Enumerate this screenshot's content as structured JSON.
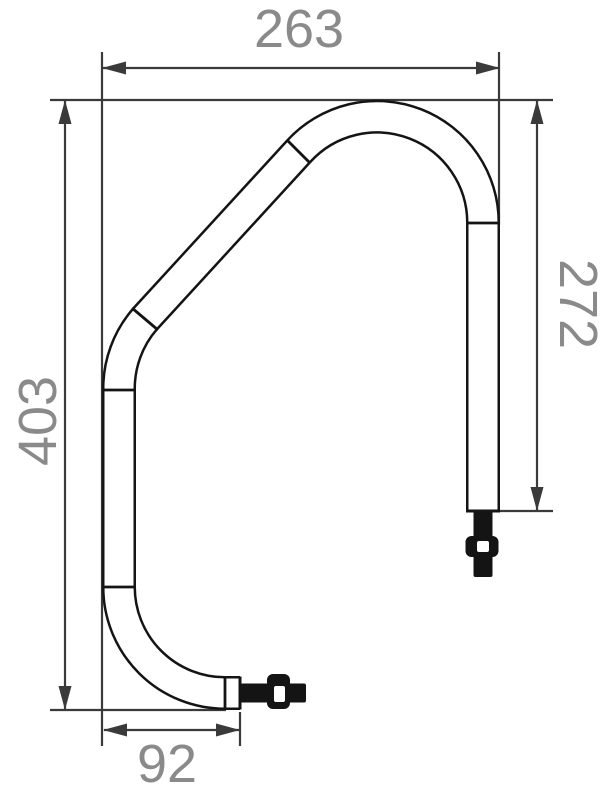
{
  "drawing": {
    "type": "technical-dimension-drawing",
    "background": "#ffffff",
    "tube_line_color": "#141414",
    "dimension_line_color": "#3a3a3a",
    "label_color": "#8a8a8a",
    "dimensions": {
      "top_width": "263",
      "left_height": "403",
      "right_height": "272",
      "bottom_width": "92"
    }
  }
}
